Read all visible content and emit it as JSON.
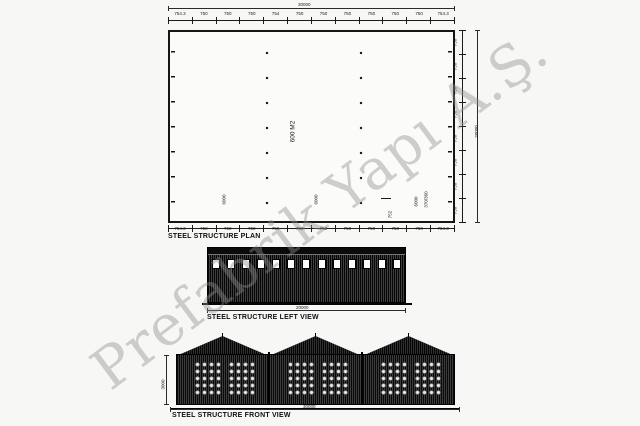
{
  "watermark": {
    "text": "Prefabrik Yapı A.Ş."
  },
  "colors": {
    "line": "#1a1a1a",
    "background": "#f7f7f5",
    "dark_fill": "#161616",
    "watermark": "#8f8f8f"
  },
  "plan": {
    "caption": "STEEL STRUCTURE PLAN",
    "area_label": "600 M2",
    "overall_width_label": "30000",
    "overall_height_label": "20000",
    "top_chain_labels": [
      "754.3",
      "750",
      "750",
      "750",
      "754",
      "750",
      "750",
      "750",
      "750",
      "750",
      "750",
      "754.3"
    ],
    "bottom_chain_labels": [
      "754.3",
      "750",
      "750",
      "750",
      "750",
      "750",
      "750",
      "750",
      "750",
      "750",
      "750",
      "754.3"
    ],
    "right_chain_labels": [
      "750",
      "750",
      "750",
      "750",
      "750",
      "750",
      "750",
      "750"
    ],
    "bay_labels": [
      "6000",
      "6000",
      "6000"
    ],
    "frame_note": "370/360",
    "offset_label": "752"
  },
  "left_view": {
    "caption": "STEEL STRUCTURE LEFT VIEW",
    "length_label": "20000",
    "window_count": "13"
  },
  "front_view": {
    "caption": "STEEL STRUCTURE FRONT VIEW",
    "width_label": "30000",
    "height_label": "3000",
    "bay_count": "3"
  }
}
